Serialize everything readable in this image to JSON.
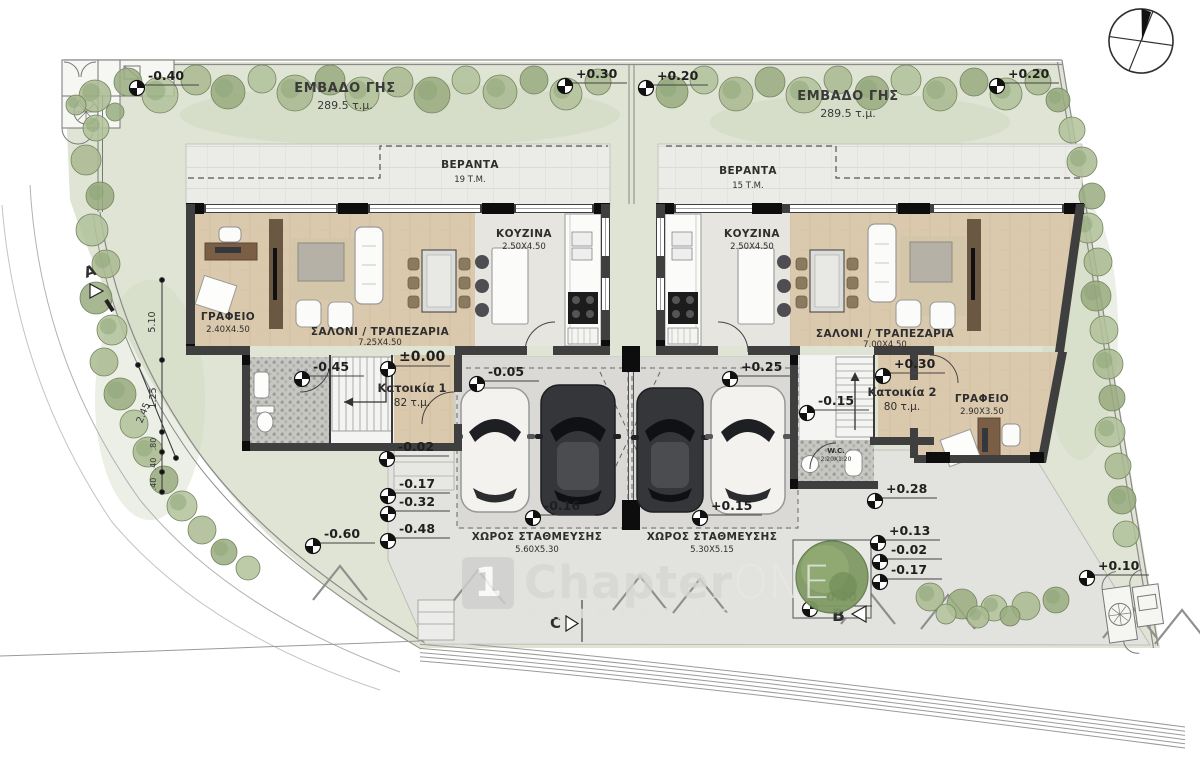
{
  "plan": {
    "plots": [
      {
        "label": "ΕΜΒΑΔΟ ΓΗΣ",
        "area": "289.5 τ.μ."
      },
      {
        "label": "ΕΜΒΑΔΟ ΓΗΣ",
        "area": "289.5 τ.μ."
      }
    ],
    "houses": [
      {
        "name": "Κατοικία 1",
        "area": "82 τ.μ.",
        "veranda": {
          "label": "ΒΕΡΑΝΤΑ",
          "area": "19 Τ.Μ."
        },
        "kitchen": {
          "label": "ΚΟΥΖΙΝΑ",
          "dims": "2.50Χ4.50"
        },
        "office": {
          "label": "ΓΡΑΦΕΙΟ",
          "dims": "2.40Χ4.50"
        },
        "living": {
          "label": "ΣΑΛΟΝΙ / ΤΡΑΠΕΖΑΡΙΑ",
          "dims": "7.25Χ4.50"
        },
        "parking": {
          "label": "ΧΩΡΟΣ ΣΤΑΘΜΕΥΣΗΣ",
          "dims": "5.60Χ5.30"
        }
      },
      {
        "name": "Κατοικία 2",
        "area": "80 τ.μ.",
        "veranda": {
          "label": "ΒΕΡΑΝΤΑ",
          "area": "15 Τ.Μ."
        },
        "kitchen": {
          "label": "ΚΟΥΖΙΝΑ",
          "dims": "2.50Χ4.50"
        },
        "office": {
          "label": "ΓΡΑΦΕΙΟ",
          "dims": "2.90Χ3.50"
        },
        "living": {
          "label": "ΣΑΛΟΝΙ / ΤΡΑΠΕΖΑΡΙΑ",
          "dims": "7.00Χ4.50"
        },
        "wc": {
          "label": "W.C.",
          "dims": "2.20Χ1.20"
        },
        "parking": {
          "label": "ΧΩΡΟΣ ΣΤΑΘΜΕΥΣΗΣ",
          "dims": "5.30Χ5.15"
        }
      }
    ],
    "levels": [
      {
        "label": "-0.40"
      },
      {
        "label": "+0.30"
      },
      {
        "label": "+0.20"
      },
      {
        "label": "+0.20"
      },
      {
        "label": "±0.00"
      },
      {
        "label": "-0.45"
      },
      {
        "label": "-0.05"
      },
      {
        "label": "+0.25"
      },
      {
        "label": "+0.30"
      },
      {
        "label": "-0.15"
      },
      {
        "label": "-0.02"
      },
      {
        "label": "-0.17"
      },
      {
        "label": "-0.32"
      },
      {
        "label": "-0.48"
      },
      {
        "label": "-0.60"
      },
      {
        "label": "-0.16"
      },
      {
        "label": "+0.15"
      },
      {
        "label": "+0.28"
      },
      {
        "label": "+0.13"
      },
      {
        "label": "-0.02"
      },
      {
        "label": "-0.17"
      },
      {
        "label": "-0.20"
      },
      {
        "label": "+0.10"
      }
    ],
    "dims_left": [
      "5.10",
      "1.25",
      "2.45",
      ".80",
      ".40",
      ".40"
    ],
    "section_markers": [
      "A",
      "B",
      "C"
    ],
    "watermark": {
      "logo": "1",
      "name_a": "Chapter",
      "name_b": "ONE",
      "sub": "PROPERTIES"
    }
  }
}
